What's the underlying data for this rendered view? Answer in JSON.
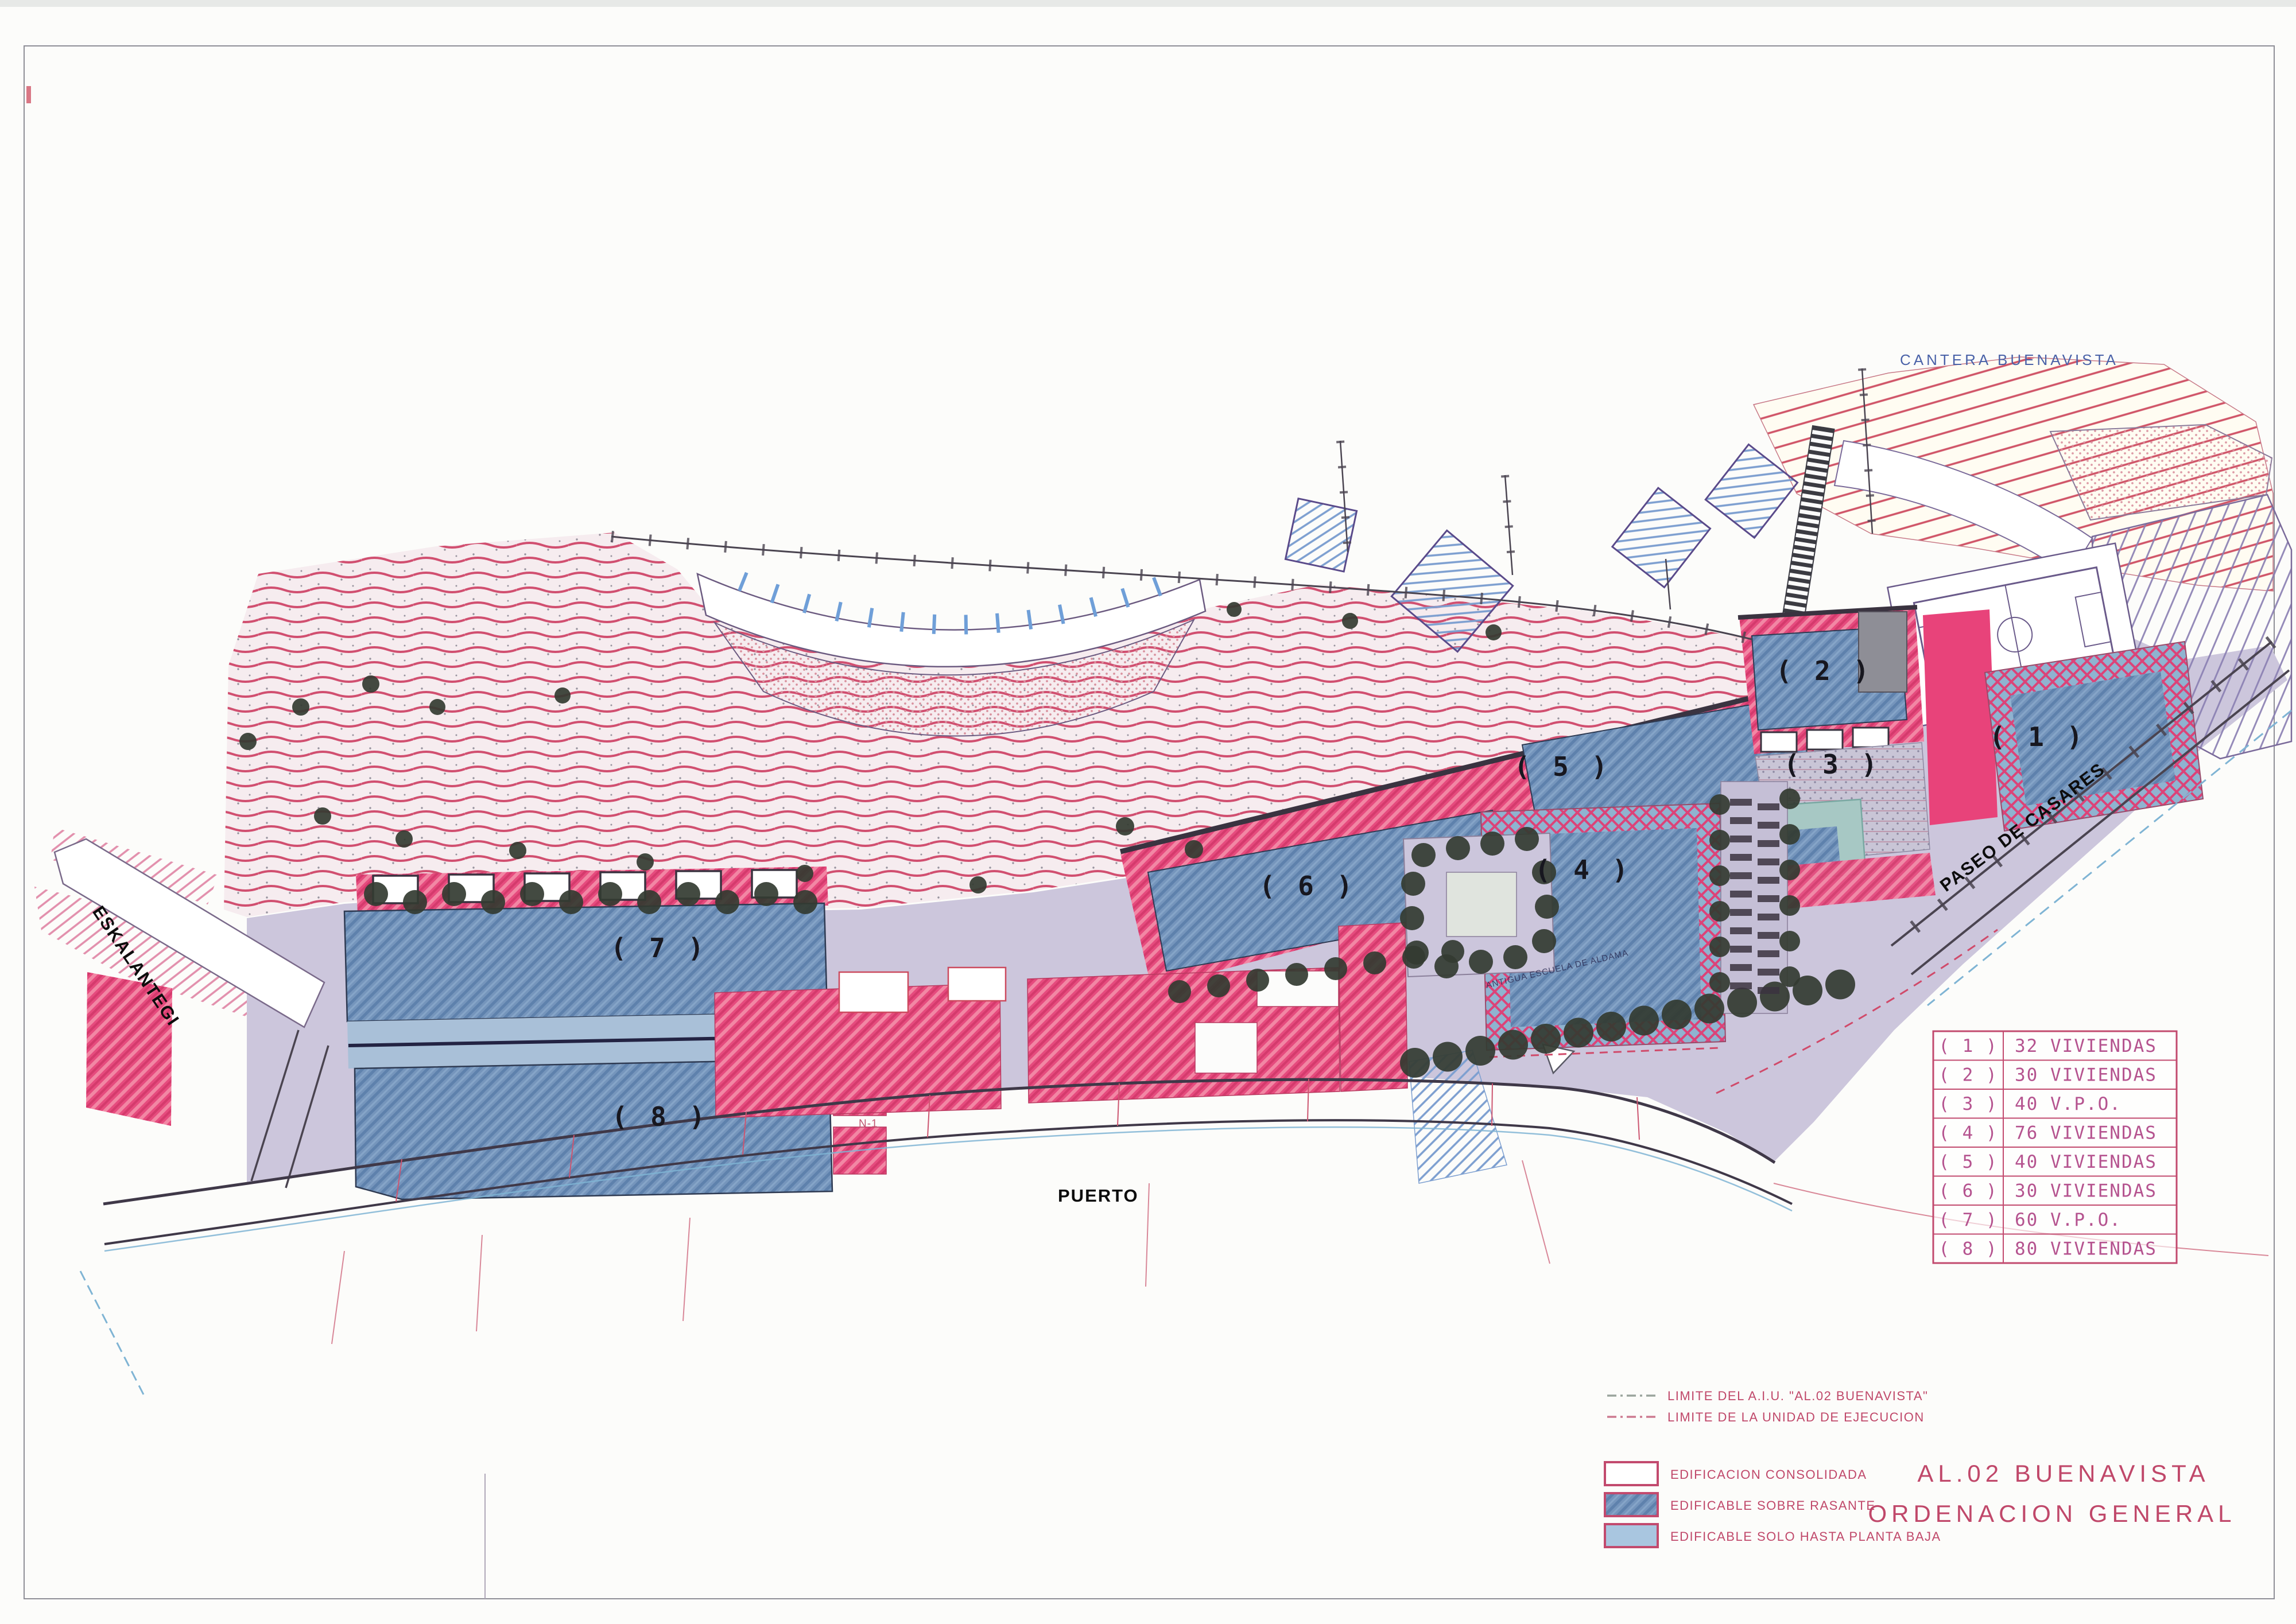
{
  "page": {
    "title_line1": "AL.02 BUENAVISTA",
    "title_line2": "ORDENACION GENERAL"
  },
  "map_labels": {
    "cantera_buenavista": "CANTERA BUENAVISTA",
    "paseo_de_casares": "PASEO DE CASARES",
    "eskalantegi": "ESKALANTEGI",
    "puerto": "PUERTO",
    "road_n1": "N-1",
    "plaza_caption": "ANTIGUA ESCUELA DE ALDAMA"
  },
  "zones": [
    {
      "marker": "( 1 )",
      "value": "32 VIVIENDAS"
    },
    {
      "marker": "( 2 )",
      "value": "30 VIVIENDAS"
    },
    {
      "marker": "( 3 )",
      "value": "40 V.P.O."
    },
    {
      "marker": "( 4 )",
      "value": "76 VIVIENDAS"
    },
    {
      "marker": "( 5 )",
      "value": "40 VIVIENDAS"
    },
    {
      "marker": "( 6 )",
      "value": "30 VIVIENDAS"
    },
    {
      "marker": "( 7 )",
      "value": "60 V.P.O."
    },
    {
      "marker": "( 8 )",
      "value": "80 VIVIENDAS"
    }
  ],
  "line_legend": [
    {
      "label": "LIMITE DEL A.I.U. \"AL.02 BUENAVISTA\""
    },
    {
      "label": "LIMITE DE LA UNIDAD DE EJECUCION"
    }
  ],
  "fill_legend": [
    {
      "label": "EDIFICACION CONSOLIDADA"
    },
    {
      "label": "EDIFICABLE SOBRE RASANTE"
    },
    {
      "label": "EDIFICABLE SOLO HASTA PLANTA BAJA"
    }
  ],
  "colors": {
    "contour_red": "#d14f70",
    "built_pink": "#e64b7e",
    "buildable_blue": "#7595bc",
    "ground_floor_blue": "#a9c6e0",
    "road_lavender": "#ccc6dc",
    "legend_ink": "#b5538f",
    "title_ink": "#c0486a",
    "label_blue": "#4a62a8"
  }
}
